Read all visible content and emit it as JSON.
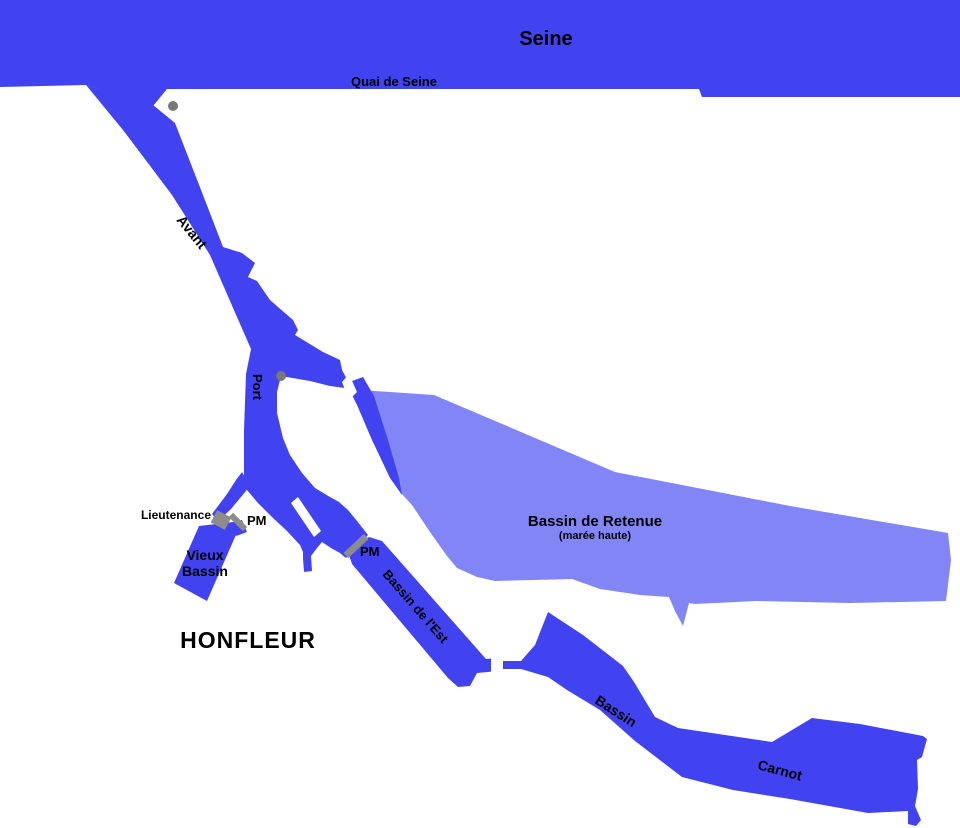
{
  "colors": {
    "water": "#4143f0",
    "water_tidal": "#8285f5",
    "marker": "#8c8c8c",
    "dot": "#787878",
    "background": "#ffffff",
    "label": "#000000"
  },
  "map": {
    "town": "HONFLEUR",
    "river": {
      "name": "Seine",
      "quay": "Quai de Seine"
    },
    "channels": {
      "avant": "Avant",
      "port": "Port"
    },
    "basins": {
      "vieux": {
        "line1": "Vieux",
        "line2": "Bassin"
      },
      "retenue": {
        "name": "Bassin de Retenue",
        "note": "(marée haute)"
      },
      "est": {
        "name": "Bassin de l'Est"
      },
      "carnot": {
        "line1": "Bassin",
        "line2": "Carnot"
      }
    },
    "markers": {
      "lieutenance": "Lieutenance",
      "pm_vieux": "PM",
      "pm_est": "PM"
    }
  }
}
